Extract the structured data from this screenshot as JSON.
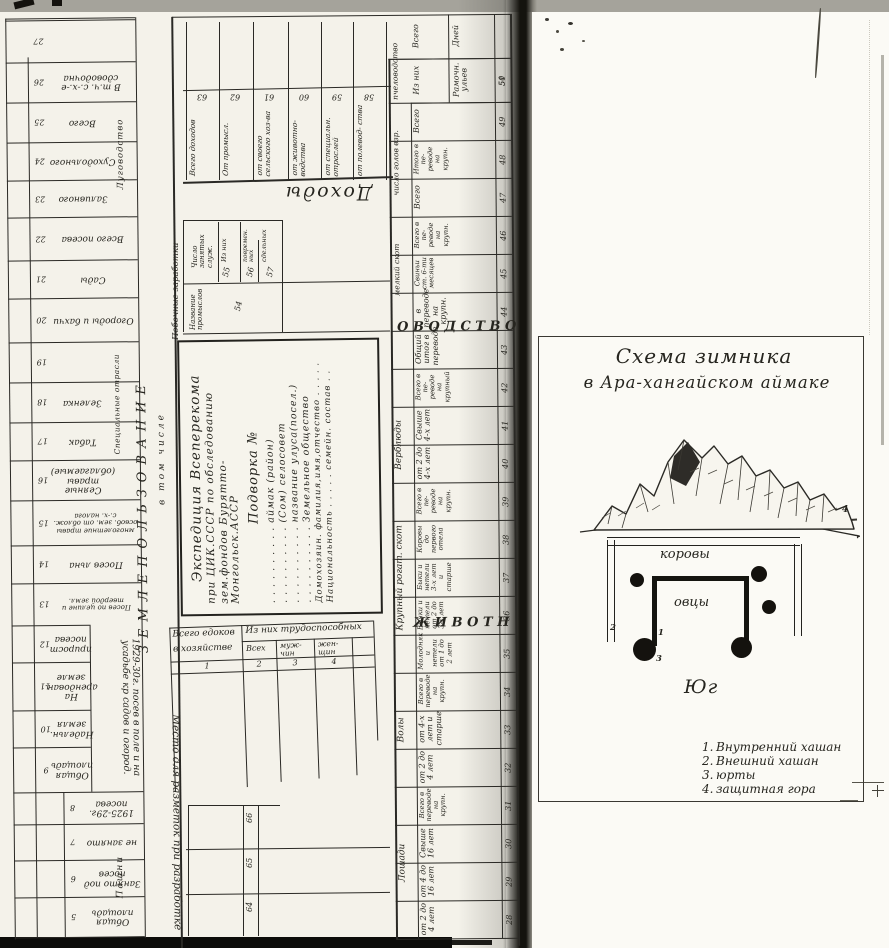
{
  "left_page": {
    "section_land": "ЗЕМЛЕПОЛЬЗОВАНИЕ",
    "in_total": "в том числе",
    "arable": "Пашни",
    "special": "Специальные отрасли",
    "meadow": "Луговодство",
    "notes_label": "Место для разметок при разработке",
    "group_1929": "1929-30г. посев в поле и на усадьбе кр садов и огород.",
    "left_columns": [
      {
        "num": "27",
        "label": ""
      },
      {
        "num": "26",
        "label": "В т.ч. с.-х.-е сдоводочна"
      },
      {
        "num": "25",
        "label": "Всего"
      },
      {
        "num": "24",
        "label": "Суходольного"
      },
      {
        "num": "23",
        "label": "Заливного"
      },
      {
        "num": "22",
        "label": "Всего посева"
      },
      {
        "num": "21",
        "label": "Сады"
      },
      {
        "num": "20",
        "label": "Огороды и бахчи"
      },
      {
        "num": "19",
        "label": ""
      },
      {
        "num": "18",
        "label": "Зеленка"
      },
      {
        "num": "17",
        "label": "Табак"
      },
      {
        "num": "16",
        "label": "Сеяные травы (облагаемые)"
      },
      {
        "num": "15",
        "label": "многолетние травы освоб. зем. от облож. с.-х. налога"
      },
      {
        "num": "14",
        "label": "Посев льна"
      },
      {
        "num": "13",
        "label": "Посев по целине и твердой земл."
      },
      {
        "num": "12",
        "label": "прирост посева"
      },
      {
        "num": "11",
        "label": "На арендован. земле"
      },
      {
        "num": "10",
        "label": "Надельн. земля"
      },
      {
        "num": "9",
        "label": "Общая площадь"
      },
      {
        "num": "8",
        "label": "1925-29г. посева"
      },
      {
        "num": "7",
        "label": "не занято"
      },
      {
        "num": "6",
        "label": "Занято под посев"
      },
      {
        "num": "5",
        "label": "Общая площадь"
      }
    ],
    "title_block": {
      "l1": "Экспедиция Всеперекома",
      "l2": "при ЦИК.СССР по обследованию",
      "l3": "зем.фондов Бурятто-Монгольск.АССР",
      "l4": "Подворка №",
      "l5": ". . . . . . . . . . аймак (район)",
      "l6": ". . . . . . . . . . (Сом) селосовет",
      "l7": ". . . . . . . . . . название улуса(посел.)",
      "l8": ". . . . . . . . . . Земельное общество",
      "l9": "Домохозяин. фамилия,имя,отчество . . . . .",
      "l10": "Национальность . . . . . семейн. состав . ."
    },
    "income": {
      "word": "Доходы",
      "cols": [
        {
          "num": "63",
          "label": "Всего доходов"
        },
        {
          "num": "62",
          "label": "От промысл."
        },
        {
          "num": "61",
          "label": "от своего сельского хоз-ва"
        },
        {
          "num": "60",
          "label": "от животно- водства"
        },
        {
          "num": "59",
          "label": "от специальн. отраслей"
        },
        {
          "num": "58",
          "label": "от полевод- ства"
        }
      ]
    },
    "side_earnings": {
      "section": "Побочные заработки",
      "main": "Число занятых служ.",
      "of_them": "Из них",
      "sub1": "повремен. ных",
      "sub2": "сдельных",
      "n55": "55",
      "n56": "56",
      "n57": "57",
      "name_label": "Название промыслов",
      "n54": "54"
    },
    "eaters": {
      "col1a": "Всего едоков",
      "col1b": "в хозяйстве",
      "group": "Из них трудоспособных",
      "s1": "Всех",
      "s2": "муж- чин",
      "s3": "жен- щин",
      "n1": "1",
      "n2": "2",
      "n3": "3",
      "n4": "4"
    },
    "bottom_rows": [
      "66",
      "65",
      "64"
    ],
    "livestock": {
      "big1": "Ж И В О Т Н",
      "big2": "О В О Д С Т В О",
      "groups": [
        {
          "label": "Лошади"
        },
        {
          "label": "Волы"
        },
        {
          "label": "Крупный рогат. скот"
        },
        {
          "label": "Верблюды"
        },
        {
          "label": "мелкий скот"
        },
        {
          "label": "число голов взр."
        },
        {
          "label": "пчеловодство"
        }
      ],
      "cols": [
        {
          "num": "28",
          "label": "от 2 до 4 лет"
        },
        {
          "num": "29",
          "label": "от 4 до 16 лет"
        },
        {
          "num": "30",
          "label": "Свыше 16 лет"
        },
        {
          "num": "31",
          "label": "Всего в переводе на крупн."
        },
        {
          "num": "32",
          "label": "от 2 до 4 лет"
        },
        {
          "num": "33",
          "label": "от 4-х лет и старше"
        },
        {
          "num": "34",
          "label": "Всего в переводе на крупн."
        },
        {
          "num": "35",
          "label": "Молодняк и нетели от 1 до 2 лет"
        },
        {
          "num": "36",
          "label": "Бычки и нетели от 2 до 3-х лет"
        },
        {
          "num": "37",
          "label": "Быки и нетели 3-х лет и старше"
        },
        {
          "num": "38",
          "label": "Коровы до первого отела"
        },
        {
          "num": "39",
          "label": "Всего в пе- реводе на крупн."
        },
        {
          "num": "40",
          "label": "от 2 до 4-х лет"
        },
        {
          "num": "41",
          "label": "Свыше 4-х лет"
        },
        {
          "num": "42",
          "label": "Всего в пе- реводе на крупный"
        },
        {
          "num": "43",
          "label": "Общий итог в переводе"
        },
        {
          "num": "44",
          "label": "в переводе на крупн."
        },
        {
          "num": "45",
          "label": "Свиньи ст. 6-ти месяцев"
        },
        {
          "num": "46",
          "label": "Всего в пе- реводе на крупн."
        },
        {
          "num": "47",
          "label": "Всего"
        },
        {
          "num": "48",
          "label": "Итого в пе- реводе на крупн."
        },
        {
          "num": "49",
          "label": "Всего"
        },
        {
          "num": "50",
          "label": "Из них"
        },
        {
          "num": "51",
          "label": "Рамочн. ульев"
        },
        {
          "num": "52",
          "label": "Всего"
        },
        {
          "num": "53",
          "label": "Дней"
        }
      ]
    }
  },
  "right_page": {
    "title_line1": "Схема зимника",
    "title_line2": "в Ара-хангайском аймаке",
    "cows": "коровы",
    "sheep": "овцы",
    "south": "Юг",
    "mountain_num": "4",
    "outer_num": "2",
    "inner_num": "1",
    "yurt_num": "3",
    "legend": [
      {
        "n": "1.",
        "t": "Внутренний хашан"
      },
      {
        "n": "2.",
        "t": "Внешний хашан"
      },
      {
        "n": "3.",
        "t": "юрты"
      },
      {
        "n": "4.",
        "t": "защитная гора"
      }
    ]
  }
}
